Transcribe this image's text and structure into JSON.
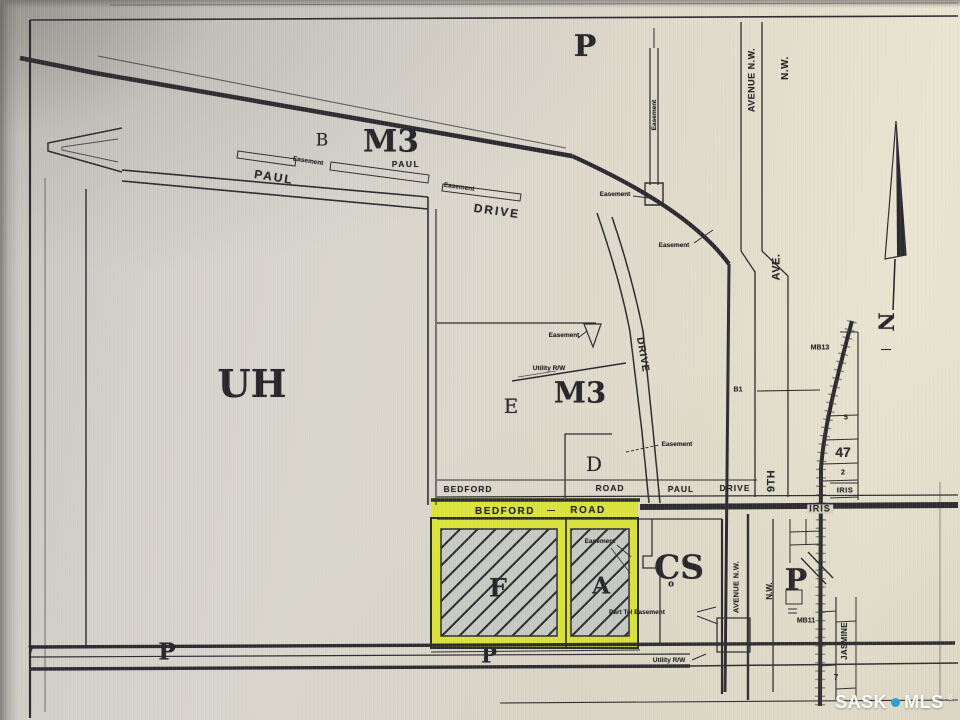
{
  "title": "Zoning plat map photo - Bedford Road / Paul Drive area",
  "colors": {
    "highlight": "#dde63a",
    "line": "#2b2b31",
    "watermark_dot": "#2d9fd0",
    "hatch_fill": "#c9cdc5"
  },
  "watermark": {
    "sask": "SASK",
    "mls": "MLS",
    "reg": "®"
  },
  "compass": {
    "letter": "N"
  },
  "labels": [
    {
      "name": "zone-p-top",
      "text": "P",
      "x": 585,
      "y": 47,
      "size": 30,
      "font": "serif",
      "weight": 700
    },
    {
      "name": "zone-b",
      "text": "B",
      "x": 322,
      "y": 141,
      "size": 17,
      "font": "serif",
      "weight": 400
    },
    {
      "name": "zone-m3-top",
      "text": "M3",
      "x": 391,
      "y": 142,
      "size": 31,
      "font": "serif",
      "weight": 700
    },
    {
      "name": "zone-uh",
      "text": "UH",
      "x": 252,
      "y": 384,
      "size": 38,
      "font": "serif",
      "weight": 700
    },
    {
      "name": "zone-e",
      "text": "E",
      "x": 511,
      "y": 406,
      "size": 20,
      "font": "serif",
      "weight": 400
    },
    {
      "name": "zone-m3-mid",
      "text": "M3",
      "x": 580,
      "y": 393,
      "size": 29,
      "font": "serif",
      "weight": 700
    },
    {
      "name": "zone-d",
      "text": "D",
      "x": 594,
      "y": 464,
      "size": 20,
      "font": "serif",
      "weight": 400
    },
    {
      "name": "zone-cs",
      "text": "CS",
      "x": 679,
      "y": 567,
      "size": 33,
      "font": "serif",
      "weight": 700
    },
    {
      "name": "zone-cs-sub",
      "text": "o",
      "x": 671,
      "y": 585,
      "size": 9,
      "font": "serif",
      "weight": 700
    },
    {
      "name": "zone-p-right",
      "text": "P",
      "x": 796,
      "y": 581,
      "size": 30,
      "font": "serif",
      "weight": 700
    },
    {
      "name": "zone-p-bottom-left",
      "text": "P",
      "x": 167,
      "y": 652,
      "size": 23,
      "font": "serif",
      "weight": 700
    },
    {
      "name": "zone-p-bottom-mid",
      "text": "P",
      "x": 489,
      "y": 655,
      "size": 21,
      "font": "serif",
      "weight": 700
    },
    {
      "name": "parcel-f-label",
      "text": "F",
      "x": 498,
      "y": 588,
      "size": 25,
      "font": "serif",
      "weight": 700
    },
    {
      "name": "parcel-a-label",
      "text": "A",
      "x": 601,
      "y": 586,
      "size": 23,
      "font": "serif",
      "weight": 700
    },
    {
      "name": "street-paul-upper",
      "text": "PAUL",
      "x": 274,
      "y": 177,
      "size": 12,
      "rot": 9,
      "ls": 2
    },
    {
      "name": "street-paul-small",
      "text": "PAUL",
      "x": 406,
      "y": 164,
      "size": 8.5,
      "ls": 1.5
    },
    {
      "name": "street-drive-upper",
      "text": "DRIVE",
      "x": 497,
      "y": 211,
      "size": 12,
      "rot": 8,
      "ls": 2
    },
    {
      "name": "street-drive-south",
      "text": "DRIVE",
      "x": 642,
      "y": 355,
      "size": 10,
      "rot": 80,
      "ls": 1
    },
    {
      "name": "street-avenue-nw-top",
      "text": "AVENUE N.W.",
      "x": 752,
      "y": 80,
      "size": 9,
      "rot": -90,
      "ls": 0.5
    },
    {
      "name": "street-nw-top",
      "text": "N.W.",
      "x": 786,
      "y": 68,
      "size": 10,
      "rot": -90,
      "ls": 0.5
    },
    {
      "name": "street-ave",
      "text": "AVE.",
      "x": 777,
      "y": 267,
      "size": 11,
      "rot": -90,
      "ls": 0.5
    },
    {
      "name": "street-9th",
      "text": "9TH",
      "x": 772,
      "y": 481,
      "size": 11,
      "rot": -90,
      "ls": 0.5
    },
    {
      "name": "street-bedford-box",
      "text": "BEDFORD",
      "x": 468,
      "y": 489,
      "size": 8.5,
      "ls": 1
    },
    {
      "name": "street-road-box",
      "text": "ROAD",
      "x": 610,
      "y": 488,
      "size": 8.5,
      "ls": 1
    },
    {
      "name": "street-paul-box",
      "text": "PAUL",
      "x": 681,
      "y": 489,
      "size": 8.5,
      "ls": 1
    },
    {
      "name": "street-drive-box",
      "text": "DRIVE",
      "x": 735,
      "y": 488,
      "size": 8.5,
      "ls": 1
    },
    {
      "name": "street-bedford-on-road",
      "text": "BEDFORD",
      "x": 505,
      "y": 512,
      "size": 10,
      "ls": 1.5
    },
    {
      "name": "street-bedford-dash",
      "text": "—",
      "x": 551,
      "y": 511,
      "size": 8
    },
    {
      "name": "street-road-on-road",
      "text": "ROAD",
      "x": 588,
      "y": 511,
      "size": 10,
      "ls": 1.5
    },
    {
      "name": "street-iris-on-road",
      "text": "IRIS",
      "x": 820,
      "y": 509,
      "size": 9,
      "ls": 1,
      "bg": "#d8d4c6"
    },
    {
      "name": "street-iris-box",
      "text": "IRIS",
      "x": 845,
      "y": 490,
      "size": 7.5,
      "ls": 0.5
    },
    {
      "name": "street-avenue-nw-bottom",
      "text": "AVENUE N.W.",
      "x": 736,
      "y": 587,
      "size": 7.5,
      "rot": -90,
      "ls": 0.3
    },
    {
      "name": "street-nw-bottom",
      "text": "N.W.",
      "x": 770,
      "y": 591,
      "size": 8,
      "rot": -90
    },
    {
      "name": "street-jasmine",
      "text": "JASMINE",
      "x": 845,
      "y": 641,
      "size": 8,
      "rot": -90,
      "ls": 0.3
    },
    {
      "name": "easement-paul-1",
      "text": "Easement",
      "x": 308,
      "y": 162,
      "size": 6.5,
      "rot": 9
    },
    {
      "name": "easement-paul-2",
      "text": "Easement",
      "x": 459,
      "y": 188,
      "size": 6.5,
      "rot": 8
    },
    {
      "name": "easement-curve-1",
      "text": "Easement",
      "x": 615,
      "y": 195,
      "size": 6.5
    },
    {
      "name": "easement-strip-vertical",
      "text": "Easement",
      "x": 655,
      "y": 115,
      "size": 6.5,
      "rot": -90
    },
    {
      "name": "easement-curve-2",
      "text": "Easement",
      "x": 674,
      "y": 246,
      "size": 6.5
    },
    {
      "name": "easement-mid",
      "text": "Easement",
      "x": 564,
      "y": 336,
      "size": 6.5
    },
    {
      "name": "utility-rw-mid",
      "text": "Utility R/W",
      "x": 549,
      "y": 369,
      "size": 6.5
    },
    {
      "name": "easement-d",
      "text": "Easement",
      "x": 677,
      "y": 445,
      "size": 6.5
    },
    {
      "name": "easement-a",
      "text": "Easement",
      "x": 600,
      "y": 542,
      "size": 6.5
    },
    {
      "name": "part-tel-easement",
      "text": "Part Tel Easement",
      "x": 637,
      "y": 613,
      "size": 6.5
    },
    {
      "name": "utility-rw-bottom",
      "text": "Utility R/W",
      "x": 669,
      "y": 661,
      "size": 6.5
    },
    {
      "name": "lot-b1",
      "text": "B1",
      "x": 738,
      "y": 390,
      "size": 7
    },
    {
      "name": "lot-mb13",
      "text": "MB13",
      "x": 820,
      "y": 348,
      "size": 7
    },
    {
      "name": "lot-5",
      "text": "5",
      "x": 846,
      "y": 418,
      "size": 7
    },
    {
      "name": "lot-47",
      "text": "47",
      "x": 843,
      "y": 452,
      "size": 14,
      "weight": 700
    },
    {
      "name": "lot-2",
      "text": "2",
      "x": 843,
      "y": 473,
      "size": 7
    },
    {
      "name": "lot-mb11",
      "text": "MB11",
      "x": 806,
      "y": 621,
      "size": 7
    },
    {
      "name": "lot-7-right",
      "text": "7",
      "x": 836,
      "y": 678,
      "size": 8
    },
    {
      "name": "lot-7-left",
      "text": "7",
      "x": 31,
      "y": 651,
      "size": 11
    },
    {
      "name": "compass-n-letter",
      "text": "N",
      "x": 886,
      "y": 322,
      "size": 21,
      "rot": 90,
      "font": "serif",
      "weight": 700
    },
    {
      "name": "compass-dash",
      "text": "—",
      "x": 886,
      "y": 350,
      "size": 10
    }
  ]
}
